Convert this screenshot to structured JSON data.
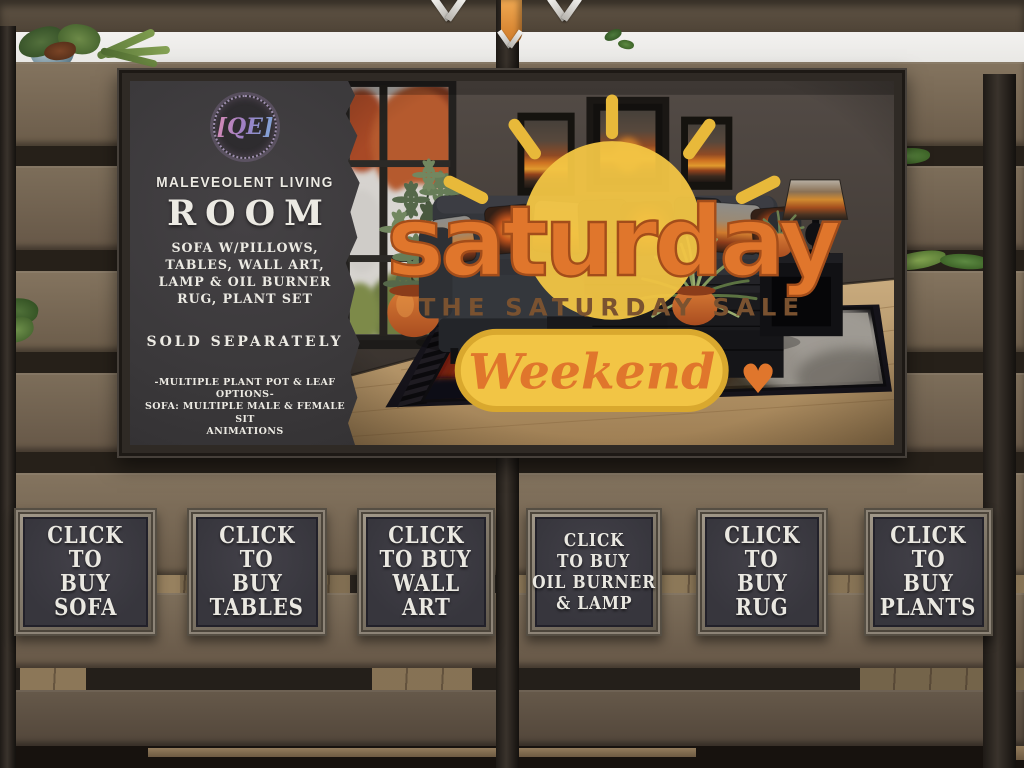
{
  "poster": {
    "logo_text": "[QE]",
    "title_small": "MALEVEOLENT LIVING",
    "title_large": "ROOM",
    "includes": {
      "line1": "SOFA W/PILLOWS,",
      "line2": "TABLES, WALL ART,",
      "line3": "LAMP & OIL BURNER",
      "line4": "RUG, PLANT SET"
    },
    "sold_separately": "SOLD SEPARATELY",
    "note1": "-MULTIPLE PLANT POT & LEAF OPTIONS-",
    "note2": "SOFA: MULTIPLE MALE & FEMALE SIT",
    "note3": "ANIMATIONS",
    "price": "FULL SET: 38L",
    "perms": "COPY / MODIFY / NO TRANS",
    "badge": {
      "title": "saturday",
      "subtitle": "THE SATURDAY SALE",
      "banner": "Weekend",
      "heart": "♥"
    }
  },
  "signs": [
    {
      "l1": "CLICK",
      "l2": "TO",
      "l3": "BUY",
      "l4": "SOFA"
    },
    {
      "l1": "CLICK",
      "l2": "TO",
      "l3": "BUY",
      "l4": "TABLES"
    },
    {
      "l1": "CLICK",
      "l2": "TO BUY",
      "l3": "WALL",
      "l4": "ART"
    },
    {
      "l1": "CLICK",
      "l2": "TO BUY",
      "l3": "OIL BURNER",
      "l4": "& LAMP"
    },
    {
      "l1": "CLICK",
      "l2": "TO",
      "l3": "BUY",
      "l4": "RUG"
    },
    {
      "l1": "CLICK",
      "l2": "TO",
      "l3": "BUY",
      "l4": "PLANTS"
    }
  ],
  "colors": {
    "chalk_text": "#eceae3",
    "sign_panel": "#38373e",
    "poster_panel": "#3b393b",
    "fence_plank": "#7a6b58",
    "accent_orange": "#e0762c",
    "badge_yellow": "#f2c545",
    "fire_orange": "#d4581e",
    "pot_terracotta": "#c25f2b"
  }
}
